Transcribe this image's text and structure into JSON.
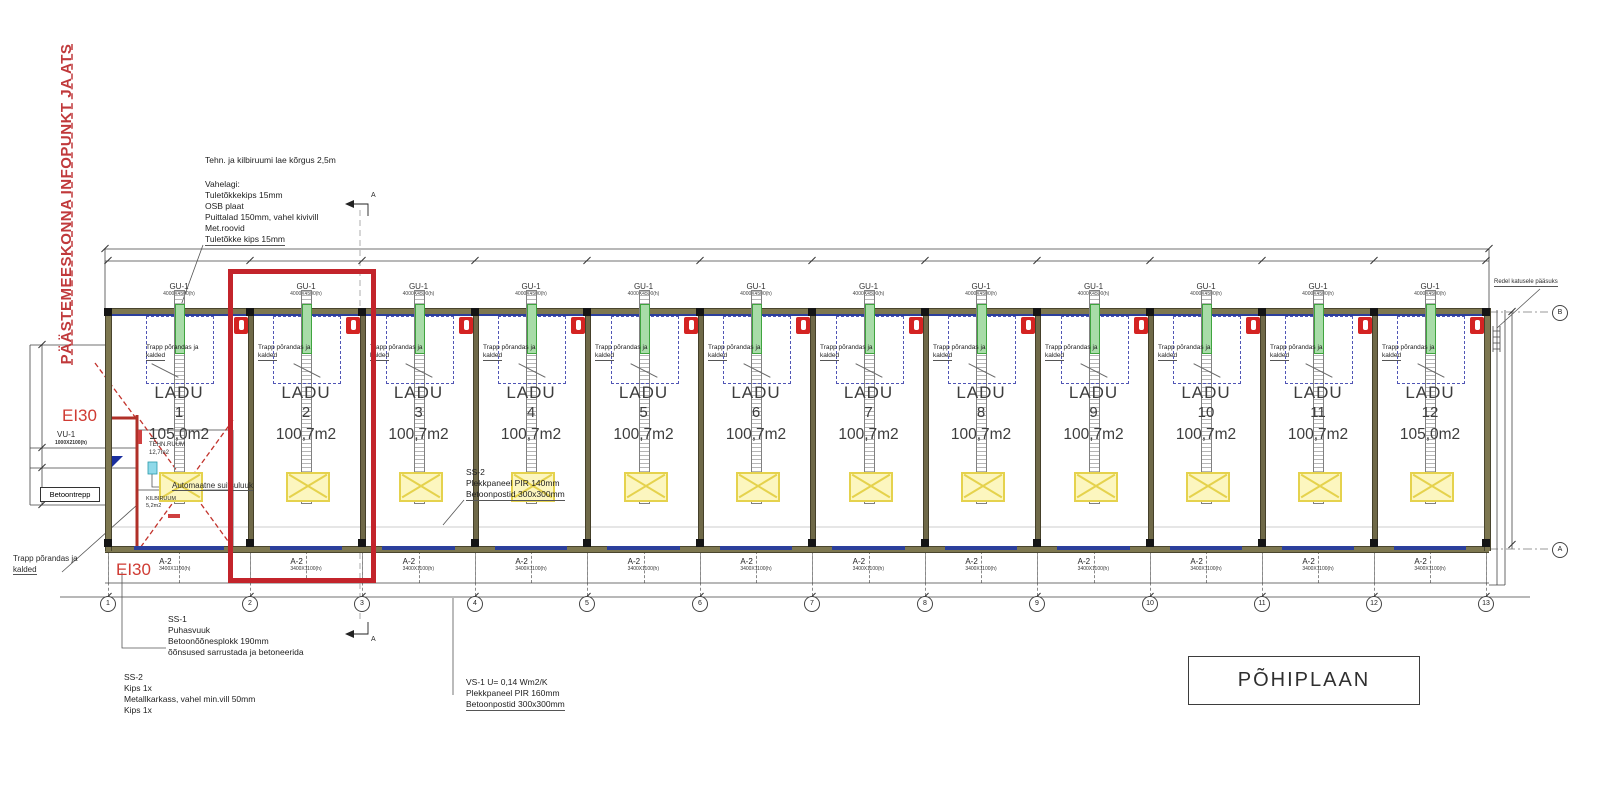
{
  "drawing": {
    "side_note_red": "PÄÄSTEMEESKONNA INFOPUNKT JA ATS",
    "title_block": "PÕHIPLAAN",
    "section_mark": "A",
    "notes": {
      "tech_ceiling": "Tehn. ja kilbiruumi lae kõrgus 2,5m",
      "vahelagi": [
        "Vahelagi:",
        "Tuletõkkekips 15mm",
        "OSB plaat",
        "Puittalad 150mm, vahel kivivill",
        "Met.roovid",
        "Tuletõkke kips 15mm"
      ],
      "ss1": [
        "SS-1",
        "Puhasvuuk",
        "Betoonõõnesplokk 190mm",
        "õõnsused sarrustada ja betoneerida"
      ],
      "ss2_mid": [
        "SS-2",
        "Plekkpaneel PIR 140mm",
        "Betoonpostid 300x300mm"
      ],
      "ss2_bottom": [
        "SS-2",
        "Kips 1x",
        "Metallkarkass, vahel min.vill 50mm",
        "Kips 1x"
      ],
      "vs1": [
        "VS-1  U= 0,14  Wm2/K",
        "Plekkpaneel PIR 160mm",
        "Betoonpostid 300x300mm"
      ],
      "smoke_hatch": "Automaatne suitsuluuk",
      "roof_ladder": "Redel katusele pääsuks",
      "trapp_outside": [
        "Trapp põrandas ja",
        "kalded"
      ]
    },
    "left_labels": {
      "ei30_top": "EI30",
      "ei30_bottom": "EI30",
      "vu1": "VU-1",
      "vu1_size": "1000X2100(h)",
      "betoontrepp": "Betoontrepp",
      "tehn_ruum": "TEHN.RUUM",
      "tehn_ruum_area": "12,7m2",
      "kilbiruum": "KILBIRUUM",
      "kilbiruum_area": "5,2m2"
    },
    "unit_common": {
      "door_top": "GU-1",
      "door_top_size": "4000X4500(h)",
      "door_bottom": "A-2",
      "door_bottom_size": "3400X1100(h)",
      "trapp_line1": "Trapp põrandas ja",
      "trapp_line2": "kalded",
      "name": "LADU"
    },
    "units": [
      {
        "number": "1",
        "area": "105,0m2"
      },
      {
        "number": "2",
        "area": "100,7m2"
      },
      {
        "number": "3",
        "area": "100,7m2"
      },
      {
        "number": "4",
        "area": "100,7m2"
      },
      {
        "number": "5",
        "area": "100,7m2"
      },
      {
        "number": "6",
        "area": "100,7m2"
      },
      {
        "number": "7",
        "area": "100,7m2"
      },
      {
        "number": "8",
        "area": "100,7m2"
      },
      {
        "number": "9",
        "area": "100,7m2"
      },
      {
        "number": "10",
        "area": "100,7m2"
      },
      {
        "number": "11",
        "area": "100,7m2"
      },
      {
        "number": "12",
        "area": "105,0m2"
      }
    ],
    "grid": {
      "columns": [
        "1",
        "2",
        "3",
        "4",
        "5",
        "6",
        "7",
        "8",
        "9",
        "10",
        "11",
        "12",
        "13"
      ],
      "rows": [
        "B",
        "A"
      ]
    },
    "colors": {
      "highlight_red": "#c3242b",
      "wall_olive": "#7d7750",
      "window_blue": "#2b3f9c",
      "hatch_yellow": "#e5d24d",
      "door_green": "#3fa43f",
      "note_red": "#c0393b"
    }
  }
}
